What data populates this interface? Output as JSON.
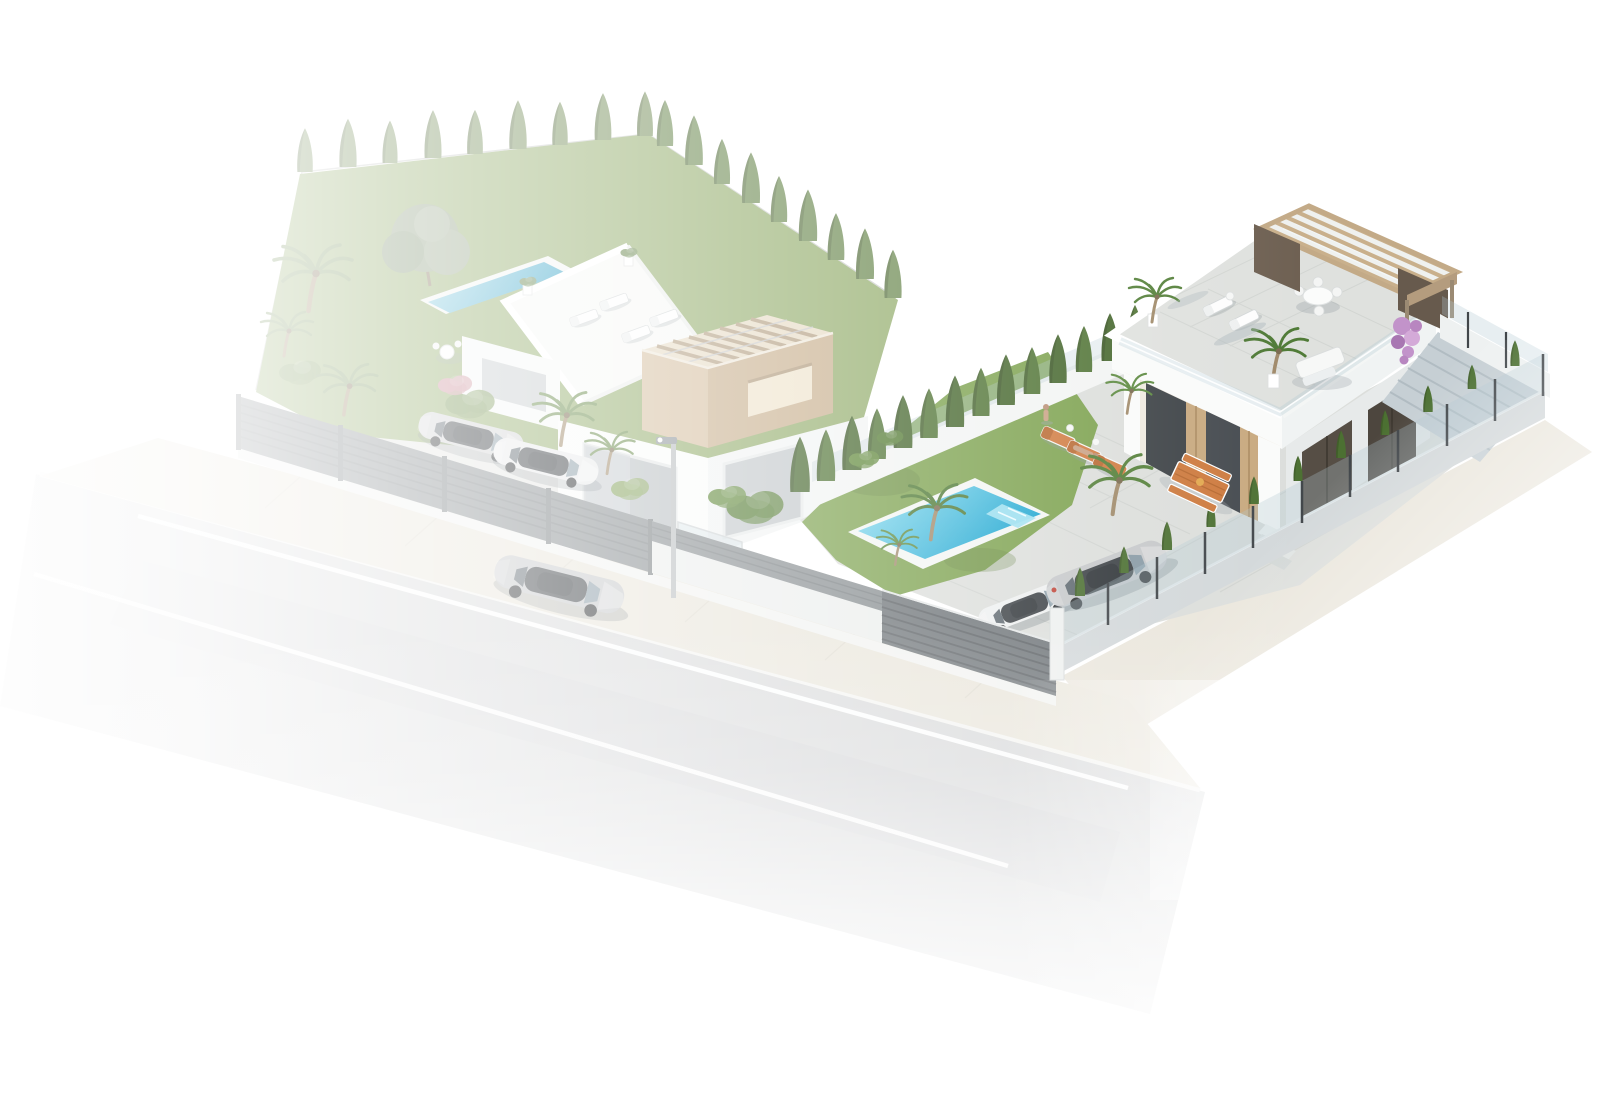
{
  "scene": {
    "type": "3d-architectural-render",
    "description": "aerial 3d render of two modern white villas on a corner plot with gardens, swimming pools, fences and a street with a driving silver sedan"
  },
  "palette": {
    "background": "#ffffff",
    "road": "#d7d8d9",
    "road_shade": "#cdcfd1",
    "lane_line": "#ffffff",
    "curb": "#f4f4f1",
    "sidewalk": "#e9e5da",
    "grass": "#7da24f",
    "grass_left": "#96af70",
    "pool_light": "#8fdff1",
    "pool_deep": "#17a3cf",
    "pool_coping": "#f3f5f3",
    "lap_pool": "#4fb3d4",
    "cypress": "#47682f",
    "cypress_faded": "#7b9361",
    "hedge": "#4c7032",
    "shrub": "#567d36",
    "olive": "#93a387",
    "palm": "#55803a",
    "palm_faded": "#7f9a66",
    "fence": "#878d90",
    "fence_dark": "#6e7478",
    "fence_slat": "#5a5f63",
    "post_white": "#eef0ef",
    "wall": "#fafbfa",
    "wall_shade": "#edf0f0",
    "wall_band": "#d3d8da",
    "beige": "#cdb493",
    "beige_light": "#e7dcc6",
    "beige_dark": "#c9b190",
    "wood": "#c9b08c",
    "brown": "#6e6052",
    "window": "#b9bfc2",
    "car_glass": "#3d4246",
    "glass_tint": "rgba(176,198,210,0.30)",
    "tile": "#dfe1de",
    "patio": "#dcdedb",
    "table_wood": "#cd7a3e",
    "cushion": "#d07c42",
    "car_silver": "#c6c8ca",
    "car_white": "#eef0f0",
    "ramp": "#c6cfd4",
    "lamp": "#b9bdc0",
    "purple": "#c293ca",
    "skin": "#c9a184",
    "shadow": "#9aa3a9"
  },
  "street": {
    "elements": [
      "asphalt-road",
      "lane-lines",
      "curb",
      "sidewalk",
      "silver-sedan",
      "street-lamp"
    ]
  },
  "left_property": {
    "elements": [
      "slat-fence",
      "lawn",
      "cypress-rows",
      "olive-tree",
      "palm-trees",
      "lap-pool",
      "roof-terrace",
      "sun-loungers",
      "pergola-tower",
      "windows",
      "carport-cars",
      "glass-gate"
    ]
  },
  "right_property": {
    "elements": [
      "patio",
      "lawn",
      "swimming-pool",
      "boundary-wall",
      "cypress-hedge",
      "slat-fence",
      "glass-fence",
      "villa-facade",
      "garage-doors",
      "roof-terrace",
      "pergola",
      "dining-set",
      "sun-loungers",
      "sofa-set",
      "picnic-table",
      "driveway-cars",
      "bougainvillea",
      "side-ramp"
    ]
  }
}
